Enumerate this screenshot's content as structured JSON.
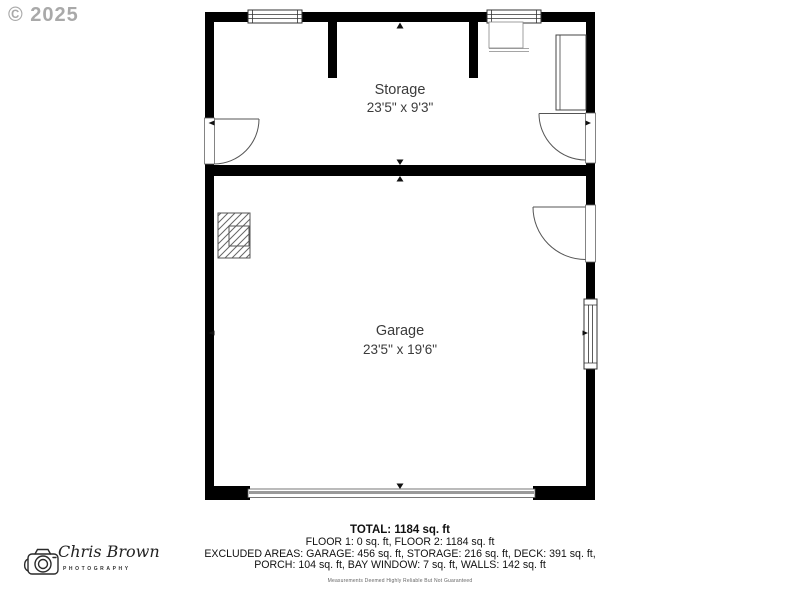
{
  "watermark": "© 2025",
  "plan": {
    "rooms": [
      {
        "name": "Storage",
        "dimensions": "23'5\" x 9'3\""
      },
      {
        "name": "Garage",
        "dimensions": "23'5\" x 19'6\""
      }
    ]
  },
  "summary": {
    "total": "TOTAL: 1184 sq. ft",
    "lines": [
      "FLOOR 1: 0 sq. ft, FLOOR 2: 1184 sq. ft",
      "EXCLUDED AREAS: GARAGE: 456 sq. ft, STORAGE: 216 sq. ft, DECK: 391 sq. ft,",
      "PORCH: 104 sq. ft, BAY WINDOW: 7 sq. ft, WALLS: 142 sq. ft"
    ],
    "disclaimer": "Measurements Deemed Highly Reliable But Not Guaranteed"
  },
  "logo": {
    "name": "Chris Brown",
    "subtitle": "PHOTOGRAPHY"
  },
  "colors": {
    "wall": "#000000",
    "thin_line": "#555555",
    "label_text": "#3b3b3b",
    "summary_text": "#111111",
    "watermark": "#9b9b9b"
  }
}
